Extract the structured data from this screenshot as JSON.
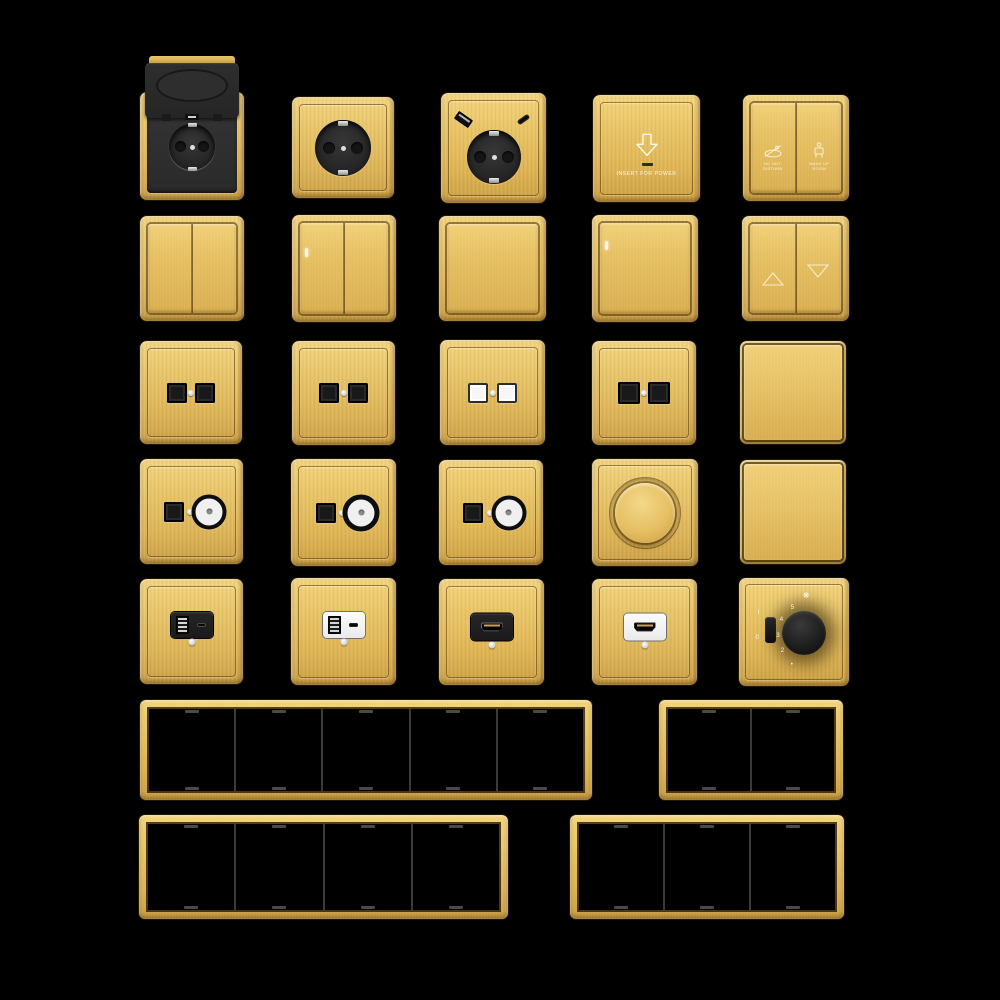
{
  "canvas": {
    "width": 1000,
    "height": 1000,
    "background": "#000000"
  },
  "palette": {
    "gold": "#E6C166",
    "gold_light": "#F3D47E",
    "gold_dark": "#C99F45",
    "module_black": "#1C1C1C",
    "module_white": "#F4F4F4",
    "frame_interior": "#000000",
    "marking_white": "#FFFFFF"
  },
  "keycard": {
    "icon": "arrow-down-icon",
    "label": "INSERT FOR POWER"
  },
  "hotel_panel": {
    "left": {
      "icon": "do-not-disturb-icon",
      "line1": "DO NOT",
      "line2": "DISTURB"
    },
    "right": {
      "icon": "make-up-room-icon",
      "line1": "MAKE UP",
      "line2": "ROOM"
    }
  },
  "fan_controller": {
    "icon": "fan-icon",
    "fan_glyph": "❋",
    "scale": [
      "5",
      "4",
      "3",
      "2"
    ],
    "scale_dot": "•",
    "toggle_on": "I",
    "toggle_off": "0"
  },
  "items": [
    {
      "name": "socket-schuko-flip-cover",
      "type": "schuko socket with black flip cover"
    },
    {
      "name": "socket-schuko",
      "type": "schuko socket black insert"
    },
    {
      "name": "socket-schuko-usb",
      "type": "schuko socket with USB-A and USB-C"
    },
    {
      "name": "keycard-power-switch",
      "type": "hotel key card energy saver"
    },
    {
      "name": "hotel-service-panel",
      "type": "two-button do-not-disturb / make-up-room panel"
    },
    {
      "name": "switch-2-gang",
      "type": "two-gang rocker switch"
    },
    {
      "name": "switch-2-gang-led",
      "type": "two-gang rocker switch with LED"
    },
    {
      "name": "switch-1-gang",
      "type": "one-gang rocker switch"
    },
    {
      "name": "switch-1-gang-led",
      "type": "one-gang rocker switch with LED"
    },
    {
      "name": "curtain-switch",
      "type": "curtain switch with up and down triangles"
    },
    {
      "name": "data-socket-double-black-a",
      "type": "double data socket black"
    },
    {
      "name": "data-socket-double-black-b",
      "type": "double data socket black"
    },
    {
      "name": "data-socket-double-white",
      "type": "double data socket white"
    },
    {
      "name": "data-socket-double-black-shuttered",
      "type": "double data socket black shuttered"
    },
    {
      "name": "blank-plate-a",
      "type": "blank cover plate"
    },
    {
      "name": "tv-data-socket-a",
      "type": "data module with coax connector"
    },
    {
      "name": "tv-data-socket-b",
      "type": "data module with coax connector"
    },
    {
      "name": "tv-data-socket-c",
      "type": "data module with coax connector"
    },
    {
      "name": "rotary-dimmer",
      "type": "rotary dimmer gold knob"
    },
    {
      "name": "blank-plate-b",
      "type": "blank cover plate"
    },
    {
      "name": "usb-charger-black",
      "type": "USB-A + USB-C charger black module"
    },
    {
      "name": "usb-charger-white",
      "type": "USB-A + USB-C charger white module"
    },
    {
      "name": "hdmi-socket-black",
      "type": "HDMI socket black module"
    },
    {
      "name": "hdmi-socket-white",
      "type": "HDMI socket white module"
    },
    {
      "name": "fan-speed-controller",
      "type": "fan speed controller with knob and toggle"
    }
  ],
  "frames": [
    {
      "name": "frame-5-gang",
      "gangs": 5
    },
    {
      "name": "frame-2-gang",
      "gangs": 2
    },
    {
      "name": "frame-4-gang",
      "gangs": 4
    },
    {
      "name": "frame-3-gang",
      "gangs": 3
    }
  ]
}
